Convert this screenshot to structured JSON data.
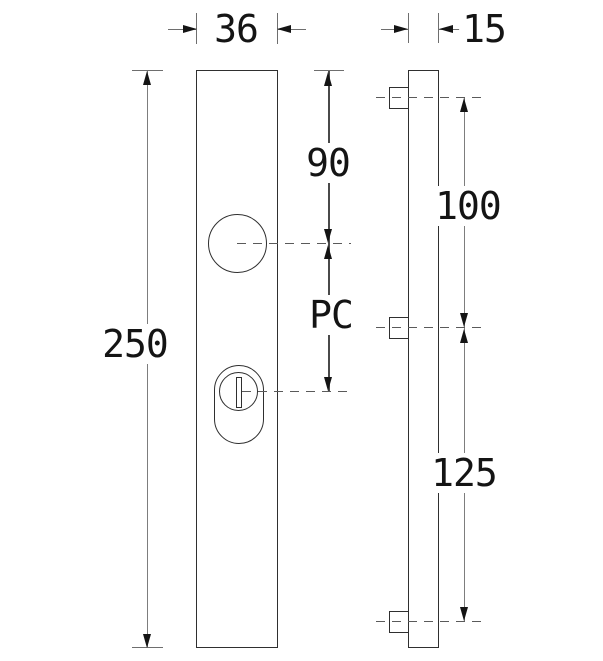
{
  "drawing": {
    "views": {
      "front": {
        "labels": {
          "width": "36",
          "height": "250",
          "top_to_handle": "90",
          "handle_to_cylinder": "PC"
        }
      },
      "side": {
        "labels": {
          "thickness": "15",
          "upper_spacing": "100",
          "lower_spacing": "125"
        }
      }
    },
    "colors": {
      "background": "#ffffff",
      "outline": "#2f2f2f",
      "dimension_line": "#7d7d7d",
      "extension_line": "#6e6e6e",
      "centerline": "#5a5a5a",
      "arrowhead": "#141414",
      "text": "#141414"
    }
  }
}
